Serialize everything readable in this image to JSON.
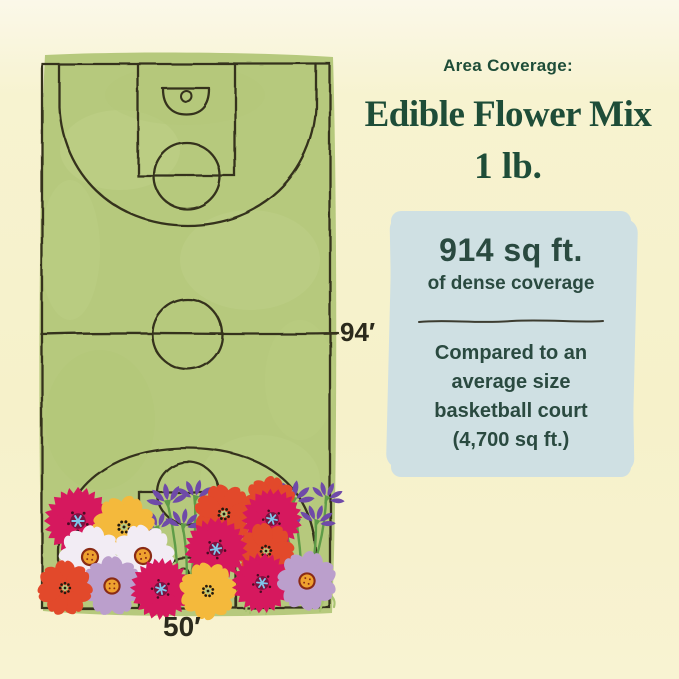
{
  "page": {
    "background": "#f6f1ca"
  },
  "header": {
    "kicker": "Area Coverage:",
    "title": "Edible Flower Mix",
    "weight": "1 lb.",
    "text_color": "#1e4d38"
  },
  "coverage_card": {
    "background": "#cfe0e3",
    "text_color": "#2a4a40",
    "value": "914 sq ft.",
    "value_caption": "of dense coverage",
    "comparison_lines": [
      "Compared to an",
      "average size",
      "basketball court",
      "(4,700 sq ft.)"
    ]
  },
  "court": {
    "label_length": "94′",
    "label_width": "50′",
    "surface_color": "#b6c97d",
    "line_color": "#35311f"
  },
  "illustration": {
    "palette": {
      "cosmos": "#d6185e",
      "red": "#e2492b",
      "yellow": "#f4b93c",
      "white": "#f2ecf4",
      "lavender": "#bb9fcc",
      "spike": "#6f4aa8",
      "stem": "#5f9c48",
      "grass": "#a9c471",
      "cosmos_center": "#7e1140",
      "cosmos_star": "#7fc6ea",
      "cosmos_dot": "#4a0a24",
      "seed_dot": "#241a0e",
      "disc": "#eea12f",
      "disc_ring": "#8a2b15"
    },
    "stems": [
      {
        "x1": 168,
        "y1": 505,
        "x2": 178,
        "y2": 583
      },
      {
        "x1": 158,
        "y1": 530,
        "x2": 172,
        "y2": 588
      },
      {
        "x1": 183,
        "y1": 528,
        "x2": 186,
        "y2": 590
      },
      {
        "x1": 195,
        "y1": 500,
        "x2": 190,
        "y2": 585
      },
      {
        "x1": 293,
        "y1": 502,
        "x2": 302,
        "y2": 588
      },
      {
        "x1": 285,
        "y1": 529,
        "x2": 297,
        "y2": 590
      },
      {
        "x1": 316,
        "y1": 524,
        "x2": 308,
        "y2": 592
      },
      {
        "x1": 326,
        "y1": 500,
        "x2": 315,
        "y2": 562
      }
    ],
    "grass": [
      [
        250,
        613,
        5
      ],
      [
        258,
        609,
        -4
      ],
      [
        266,
        614,
        5
      ],
      [
        274,
        608,
        4
      ],
      [
        246,
        611,
        -5
      ],
      [
        320,
        611,
        4
      ],
      [
        334,
        607,
        -4
      ]
    ],
    "flowers": [
      {
        "type": "spike",
        "x": 168,
        "y": 505,
        "rot": -8,
        "s": 1
      },
      {
        "type": "spike",
        "x": 158,
        "y": 530,
        "rot": -20,
        "s": 0.85
      },
      {
        "type": "spike",
        "x": 183,
        "y": 528,
        "rot": 8,
        "s": 0.9
      },
      {
        "type": "spike",
        "x": 195,
        "y": 500,
        "rot": 14,
        "s": 0.95
      },
      {
        "type": "spike",
        "x": 293,
        "y": 502,
        "rot": 10,
        "s": 1
      },
      {
        "type": "spike",
        "x": 285,
        "y": 529,
        "rot": -12,
        "s": 0.85
      },
      {
        "type": "spike",
        "x": 316,
        "y": 524,
        "rot": 18,
        "s": 0.9
      },
      {
        "type": "spike",
        "x": 326,
        "y": 500,
        "rot": 24,
        "s": 0.85
      },
      {
        "type": "red",
        "x": 270,
        "y": 503,
        "s": 0.85,
        "rot": 10
      },
      {
        "type": "red",
        "x": 224,
        "y": 514,
        "s": 0.95,
        "rot": -15
      },
      {
        "type": "cosmos",
        "x": 272,
        "y": 519,
        "s": 0.98,
        "rot": 12
      },
      {
        "type": "cosmos",
        "x": 78,
        "y": 521,
        "s": 1.1,
        "rot": 0
      },
      {
        "type": "yellow",
        "x": 124,
        "y": 527,
        "s": 1.0,
        "rot": 20
      },
      {
        "type": "red",
        "x": 266,
        "y": 551,
        "s": 0.9,
        "rot": 40
      },
      {
        "type": "cosmos",
        "x": 216,
        "y": 549,
        "s": 1.02,
        "rot": -10
      },
      {
        "type": "white",
        "x": 90,
        "y": 557,
        "s": 1.0,
        "rot": 8
      },
      {
        "type": "white",
        "x": 143,
        "y": 556,
        "s": 1.0,
        "rot": -12
      },
      {
        "type": "lavender",
        "x": 112,
        "y": 586,
        "s": 0.95,
        "rot": 0
      },
      {
        "type": "red",
        "x": 65,
        "y": 588,
        "s": 0.88,
        "rot": 0
      },
      {
        "type": "cosmos",
        "x": 161,
        "y": 589,
        "s": 1.0,
        "rot": 18
      },
      {
        "type": "yellow",
        "x": 208,
        "y": 591,
        "s": 0.92,
        "rot": -18
      },
      {
        "type": "cosmos",
        "x": 262,
        "y": 583,
        "s": 0.98,
        "rot": 6
      },
      {
        "type": "lavender",
        "x": 307,
        "y": 581,
        "s": 0.95,
        "rot": 15
      }
    ]
  }
}
